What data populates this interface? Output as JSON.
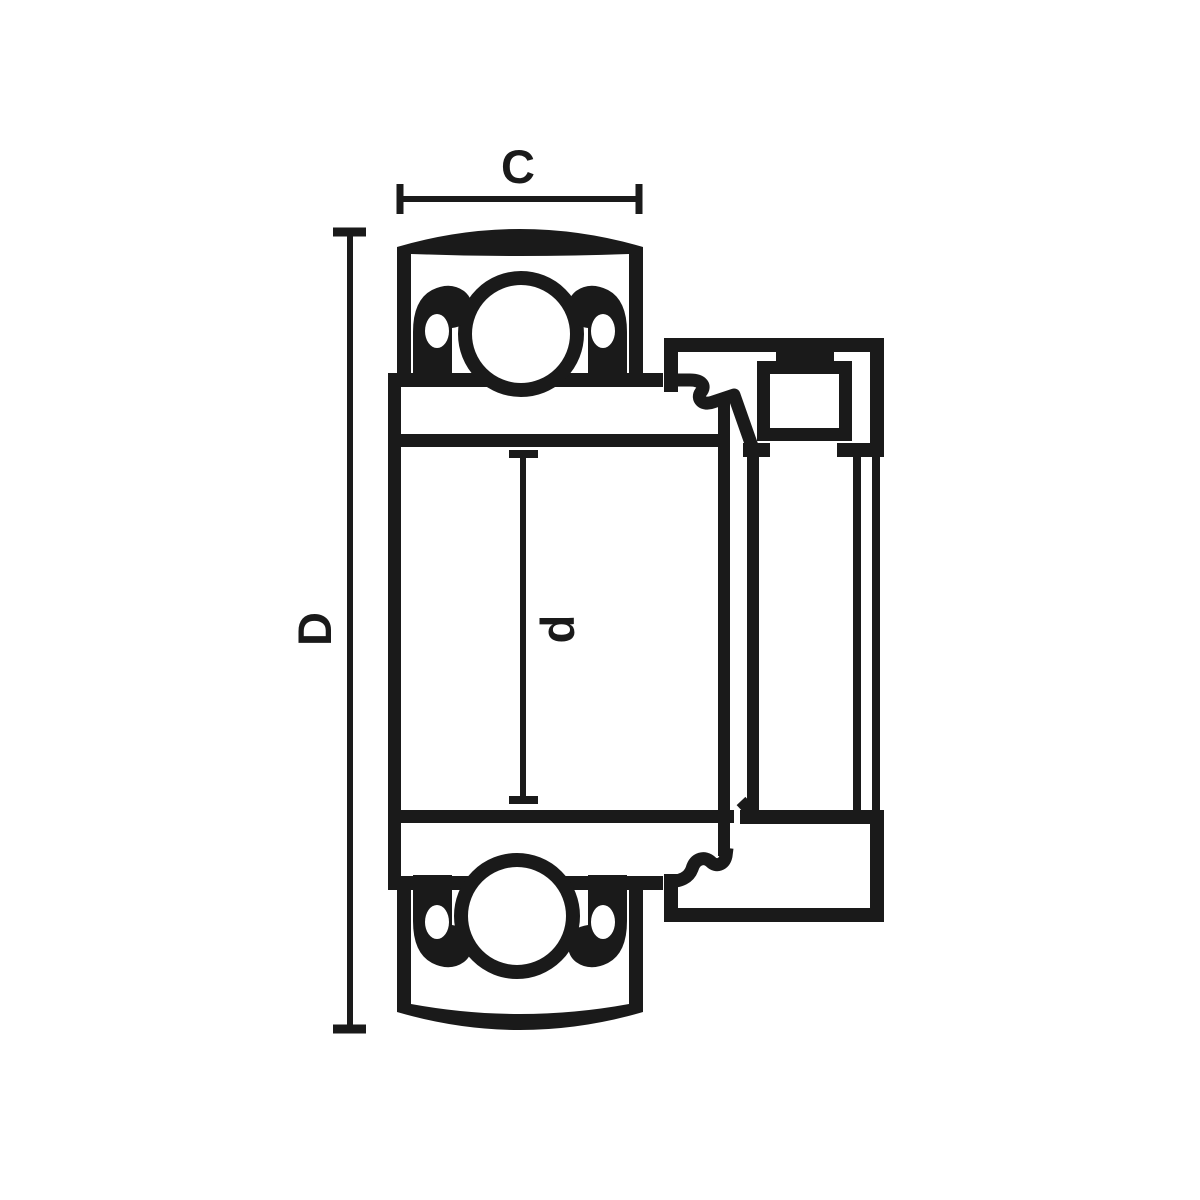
{
  "diagram": {
    "subject": "insert-ball-bearing-with-eccentric-locking-collar-cross-section",
    "background_color": "#ffffff",
    "line_color": "#1a1a1a",
    "labels": {
      "outer_ring_width": "C",
      "outer_diameter": "D",
      "bore_diameter": "d"
    }
  }
}
